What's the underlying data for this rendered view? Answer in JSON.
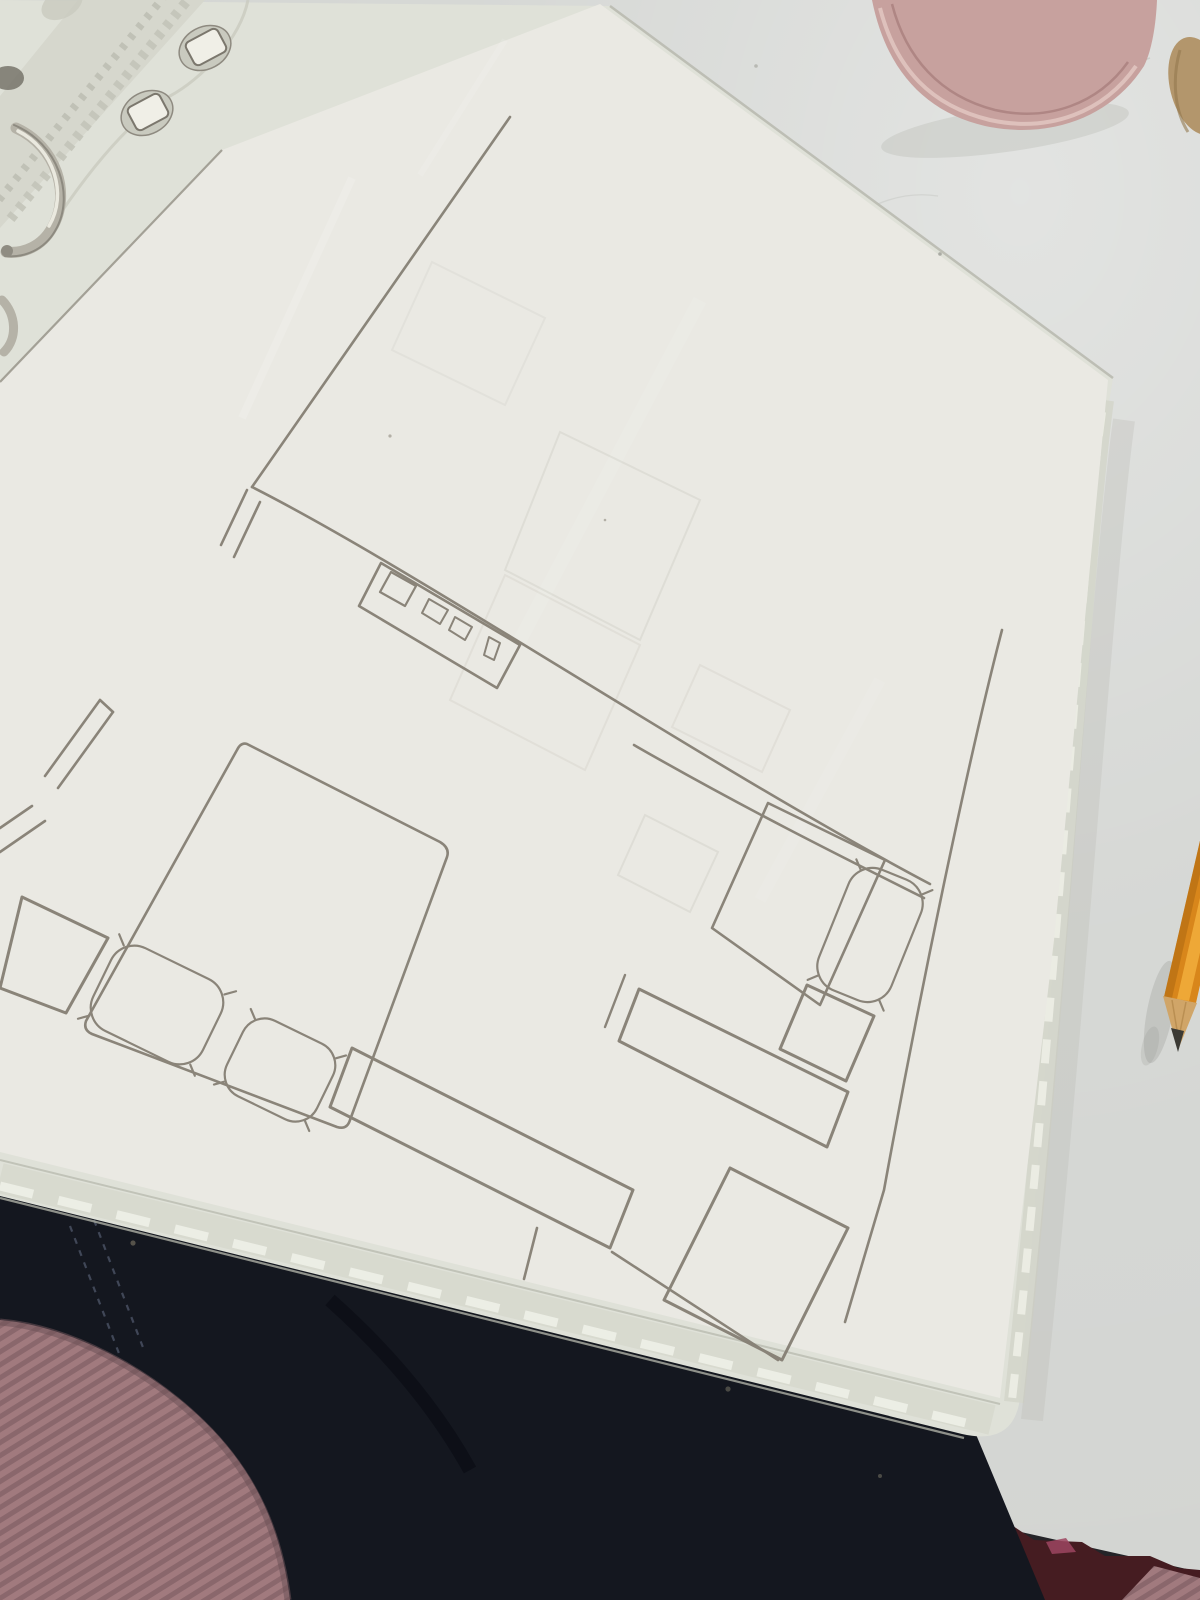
{
  "scene": {
    "setting": "overhead photo of an open ring binder on a white desk",
    "objects": [
      "ring-binder-with-sheet-protectors",
      "pencil-floor-plan-sketch-on-paper",
      "metal-binder-rings",
      "punched-holes-strip",
      "orange-wooden-pencil-sharpened",
      "pink-pen-cup-with-pens",
      "blue-pens",
      "white-pens",
      "wooden-pencils",
      "beige-object-at-edge",
      "dark-jeans",
      "mauve-ribbed-knit-sleeve",
      "white-desk-with-chipped-maroon-edge",
      "dark-floor-shadow"
    ]
  },
  "floor_plan": {
    "medium": "pencil on paper, hand-ruled",
    "rooms": [
      "upper-hall-area",
      "bedroom-left",
      "lane-right"
    ],
    "wall_features": [
      "long-outer-wall-upper-left",
      "door-jamb-double-line",
      "main-horizontal-wall",
      "right-outer-wall",
      "bottom-wall-corner"
    ],
    "furniture": [
      "corner-piece-top-left-edge",
      "bedside-square-left",
      "double-bed-rounded-corners",
      "pillow-large-on-double-bed",
      "pillow-small-on-double-bed",
      "desk-with-monitor-and-two-small-items-and-slim-object",
      "long-wardrobe-below-bed",
      "single-bed-right",
      "pillow-on-single-bed",
      "nightstand-square-right",
      "low-sideboard-long-thin",
      "cabinet-bottom-right",
      "faint-ghost-furniture-from-next-sheet"
    ]
  },
  "colors": {
    "desk": "#d3d5d2",
    "floor_shadow": "#242428",
    "desk_edge_maroon": "#451c21",
    "desk_edge_chip": "#9c4560",
    "jeans": "#14171f",
    "jeans_stitch": "#4b5365",
    "knit_base": "#a17a7e",
    "knit_rib": "#8a676c",
    "binder_sleeve": "#dfe1d8",
    "sleeve_edge_band": "#d8dacf",
    "paper": "#eae9e3",
    "paper_edge_line": "#98948a",
    "pencil_line": "#857f74",
    "ring_metal": "#b5b2a7",
    "pencil_body": "#d8861b",
    "pencil_highlight": "#f2ae3c",
    "pencil_wood": "#d0a568",
    "pencil_graphite": "#3b3a34",
    "pen_cup": "#c7a19e",
    "pen_cup_rim": "#e0c4bf",
    "pen_blue": "#4e6fc2",
    "pen_white": "#e9eceb",
    "pen_wood": "#c49145",
    "beige_object": "#b3966c"
  }
}
